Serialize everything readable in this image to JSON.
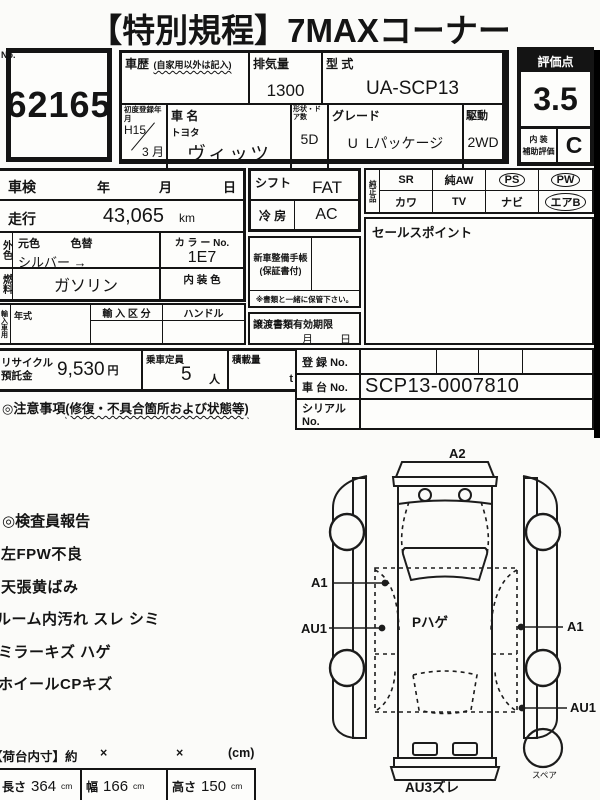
{
  "title": "【特別規程】7MAXコーナー",
  "lot": {
    "no_label": "No.",
    "number": "62165"
  },
  "vehicle": {
    "history_label": "車歴",
    "history_note": "(自家用以外は記入)",
    "displacement_label": "排気量",
    "displacement": "1300",
    "model_code_label": "型 式",
    "model_code": "UA-SCP13",
    "first_reg_label": "初度登録年月",
    "first_reg_year": "H15",
    "first_reg_month": "3 月",
    "name_label": "車 名",
    "maker": "トヨタ",
    "name": "ヴィッツ",
    "shape_label": "形状・ドア数",
    "shape": "5D",
    "grade_label": "グレード",
    "grade": "U  Lパッケージ",
    "drive_label": "駆動",
    "drive": "2WD"
  },
  "rating": {
    "score_label": "評価点",
    "score": "3.5",
    "interior_label_1": "内 装",
    "interior_label_2": "補助評価",
    "interior_grade": "C"
  },
  "inspection": {
    "label": "車検",
    "year": "年",
    "month": "月",
    "day": "日"
  },
  "mileage": {
    "label": "走行",
    "value": "43,065",
    "unit": "km"
  },
  "color": {
    "side_label": "外色",
    "orig_label": "元色",
    "change_label": "色替",
    "value": "シルバー →",
    "no_label": "カ ラ ー No.",
    "no": "1E7"
  },
  "fuel": {
    "side_label": "燃料",
    "value": "ガソリン",
    "interior_color_label": "内 装 色"
  },
  "import": {
    "side_label": "輸入車用",
    "year_label": "年式",
    "class_label": "輸 入 区 分",
    "handle_label": "ハンドル"
  },
  "recycle": {
    "label": "リサイクル預託金",
    "fee": "9,530",
    "fee_unit": "円",
    "capacity_label": "乗車定員",
    "capacity": "5",
    "capacity_unit": "人",
    "load_label": "積載量",
    "load_unit": "t"
  },
  "caution": {
    "heading": "◎注意事項",
    "heading_note": "(修復・不具合箇所および状態等)"
  },
  "center": {
    "shift_label": "シフト",
    "shift": "FAT",
    "ac_label": "冷 房",
    "ac": "AC",
    "manual_label_1": "新車整備手帳",
    "manual_label_2": "(保証書付)",
    "keep_note": "※書類と一緒に保管下さい。",
    "transfer_label": "譲渡書類有効期限",
    "transfer_month": "月",
    "transfer_day": "日"
  },
  "equipment": {
    "side_label": "純正品",
    "items": [
      {
        "label": "SR",
        "circled": false
      },
      {
        "label": "純AW",
        "circled": false
      },
      {
        "label": "PS",
        "circled": true
      },
      {
        "label": "PW",
        "circled": true
      },
      {
        "label": "カワ",
        "circled": false
      },
      {
        "label": "TV",
        "circled": false
      },
      {
        "label": "ナビ",
        "circled": false
      },
      {
        "label": "エアB",
        "circled": true
      }
    ]
  },
  "sales_point_label": "セールスポイント",
  "registration": {
    "reg_label": "登 録 No.",
    "chassis_label": "車 台 No.",
    "chassis_no": "SCP13-0007810",
    "serial_label": "シリアル No."
  },
  "report": {
    "heading": "◎検査員報告",
    "items": [
      "左FPW不良",
      "天張黄ばみ",
      "ルーム内汚れ スレ シミ",
      "ミラーキズ ハゲ",
      "ホイールCPキズ"
    ]
  },
  "diagram": {
    "top": "A2",
    "left_upper": "A1",
    "left_lower": "AU1",
    "right_upper": "A1",
    "right_lower": "AU1",
    "center_note": "Pハゲ",
    "bottom": "AU3ズレ",
    "spare": "スペア"
  },
  "cargo": {
    "heading": "【荷台内寸】約",
    "x1": "×",
    "x2": "×",
    "unit": "(cm)",
    "length_label": "長さ",
    "length": "364",
    "length_unit": "cm",
    "width_label": "幅",
    "width": "166",
    "width_unit": "cm",
    "height_label": "高さ",
    "height": "150",
    "height_unit": "cm"
  }
}
